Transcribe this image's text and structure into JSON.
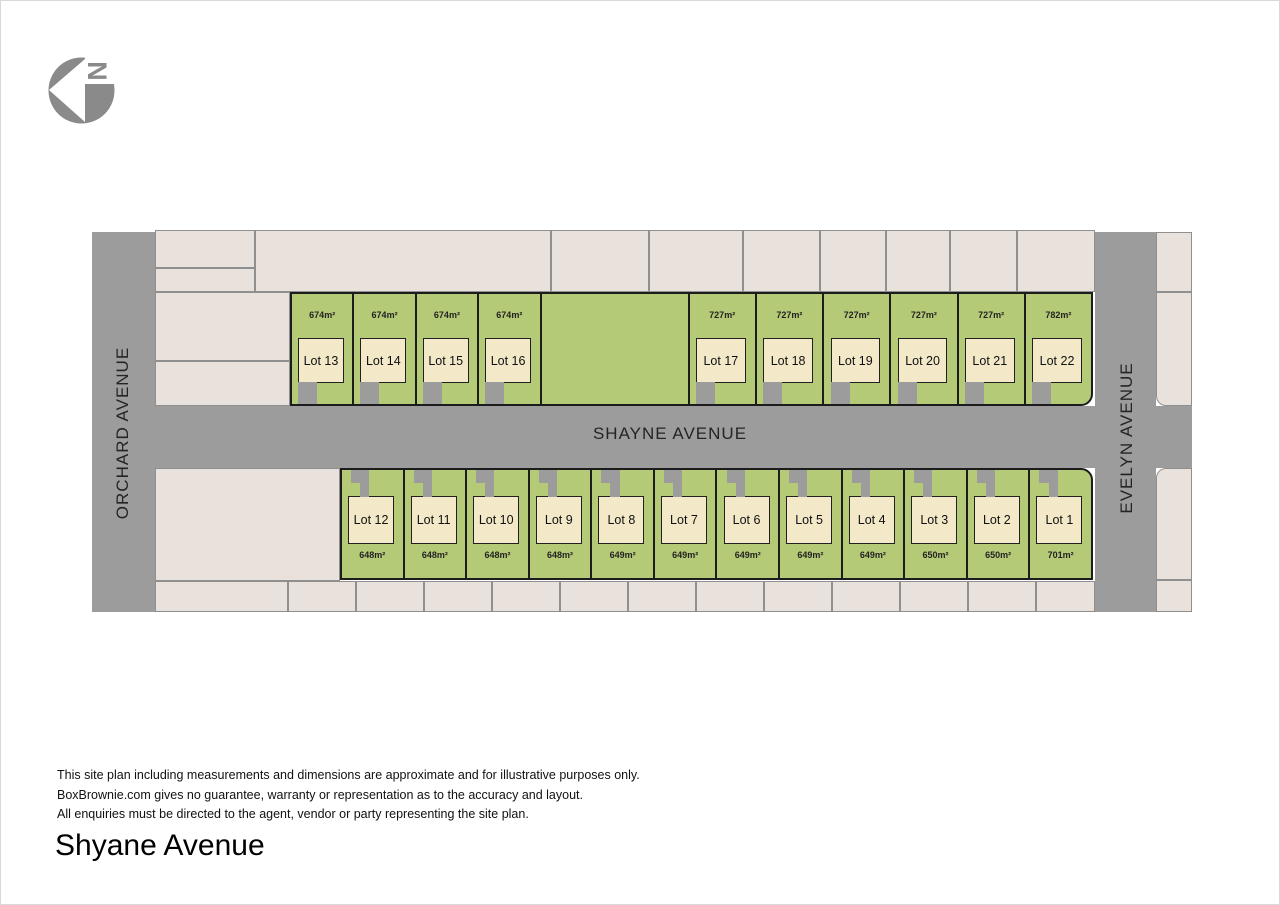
{
  "logo": {
    "north_letter": "N"
  },
  "streets": {
    "main": "SHAYNE AVENUE",
    "left": "ORCHARD AVENUE",
    "right": "EVELYN AVENUE"
  },
  "rows": {
    "top": {
      "cells": [
        {
          "name": "Lot 13",
          "area": "674m²"
        },
        {
          "name": "Lot 14",
          "area": "674m²"
        },
        {
          "name": "Lot 15",
          "area": "674m²"
        },
        {
          "name": "Lot 16",
          "area": "674m²"
        },
        {
          "type": "open_space"
        },
        {
          "name": "Lot 17",
          "area": "727m²"
        },
        {
          "name": "Lot 18",
          "area": "727m²"
        },
        {
          "name": "Lot 19",
          "area": "727m²"
        },
        {
          "name": "Lot 20",
          "area": "727m²"
        },
        {
          "name": "Lot 21",
          "area": "727m²"
        },
        {
          "name": "Lot 22",
          "area": "782m²"
        }
      ]
    },
    "bottom": {
      "cells": [
        {
          "name": "Lot 12",
          "area": "648m²"
        },
        {
          "name": "Lot 11",
          "area": "648m²"
        },
        {
          "name": "Lot 10",
          "area": "648m²"
        },
        {
          "name": "Lot 9",
          "area": "648m²"
        },
        {
          "name": "Lot 8",
          "area": "649m²"
        },
        {
          "name": "Lot 7",
          "area": "649m²"
        },
        {
          "name": "Lot 6",
          "area": "649m²"
        },
        {
          "name": "Lot 5",
          "area": "649m²"
        },
        {
          "name": "Lot 4",
          "area": "649m²"
        },
        {
          "name": "Lot 3",
          "area": "650m²"
        },
        {
          "name": "Lot 2",
          "area": "650m²"
        },
        {
          "name": "Lot 1",
          "area": "701m²"
        }
      ]
    }
  },
  "disclaimer": {
    "line1": "This site plan including measurements and dimensions are approximate and for illustrative purposes only.",
    "line2": "BoxBrownie.com gives no guarantee, warranty or representation as to the accuracy and layout.",
    "line3": "All enquiries must be directed to the agent, vendor or party representing the site plan."
  },
  "title": "Shyane Avenue",
  "colors": {
    "lot_green": "#B5CA76",
    "house_cream": "#F3E9C9",
    "road_gray": "#9C9C9C",
    "parcel_cream": "#E9E1DC",
    "line_dark": "#1C1C1C",
    "logo_gray": "#8A8A8A"
  }
}
